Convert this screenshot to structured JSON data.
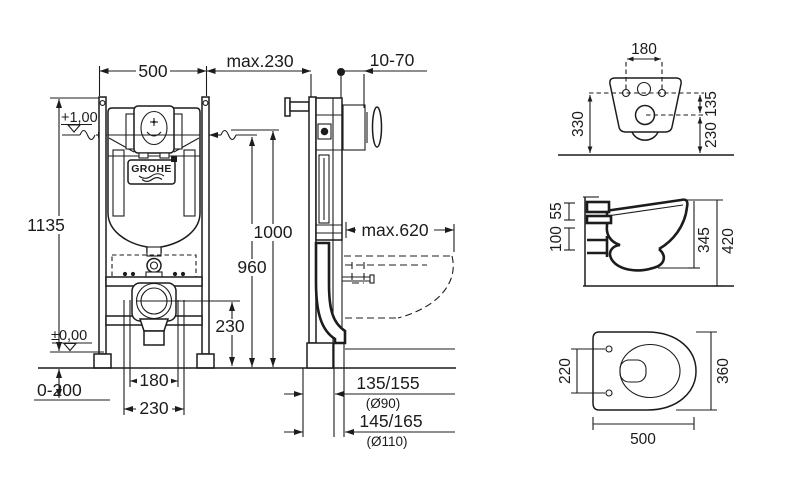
{
  "brand": {
    "logo_text": "GROHE"
  },
  "frame_front": {
    "width": "500",
    "height": "1135",
    "level_top": "+1,00",
    "level_floor": "±0,00",
    "floor_adjust": "0-200",
    "pipe_spacing_inner": "180",
    "pipe_spacing_outer": "230",
    "outlet_height": "230",
    "dim_960": "960",
    "dim_1000": "1000"
  },
  "frame_side": {
    "frame_depth": "max.230",
    "plate_distance": "10-70",
    "bowl_length_max": "max.620",
    "drain_offset_90": "135/155",
    "drain_dia_90": "(Ø90)",
    "drain_offset_110": "145/165",
    "drain_dia_110": "(Ø110)"
  },
  "bowl_back": {
    "hole_spacing": "180",
    "height_total": "330",
    "hole_to_outlet": "135",
    "outlet_height": "230"
  },
  "bowl_profile": {
    "rim_zone": "55",
    "fix_zone": "100",
    "body_height": "345",
    "total_height": "420"
  },
  "bowl_plan": {
    "hole_spacing": "220",
    "width": "360",
    "depth": "500"
  }
}
